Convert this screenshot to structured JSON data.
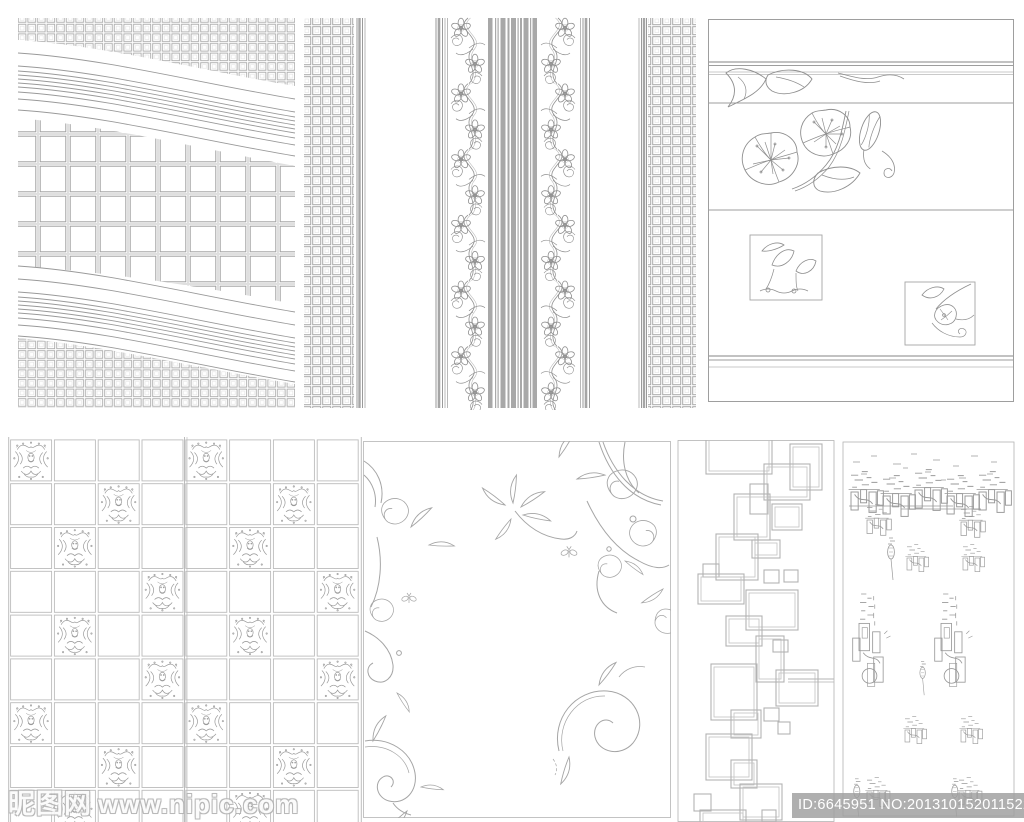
{
  "page": {
    "background": "#ffffff",
    "line_color": "#9a9a9a",
    "accent_gray": "#a8a8a8"
  },
  "watermark": {
    "site_name": "昵图网",
    "site_url": "www.nipic.com",
    "id_text": "ID:6645951 NO:20131015201152238000"
  },
  "panels": [
    {
      "id": "wave-grid",
      "label": "grid pattern crossed by wavy line bands"
    },
    {
      "id": "floral-stripe",
      "label": "vertical stripe wallpaper border with floral vines and mesh edges"
    },
    {
      "id": "flower-border",
      "label": "horizontal banded panel with hand-drawn blossoms and two framed flower sketches"
    },
    {
      "id": "damask-checker",
      "label": "checkerboard tile grid with ornate damask motifs on diagonals"
    },
    {
      "id": "swirl-flourish",
      "label": "corner floral swirl flourishes with leaves and butterflies"
    },
    {
      "id": "rect-cascade",
      "label": "cascading overlapped double-line rectangles strip"
    },
    {
      "id": "sketch-figures",
      "label": "scattered abstract plant / chandelier sketch clusters"
    }
  ],
  "damask": {
    "cols": 8,
    "rows": 9,
    "motif_rows": [
      [
        0,
        4
      ],
      [
        2,
        6
      ],
      [
        1,
        5
      ],
      [
        3,
        7
      ],
      [
        1,
        5
      ],
      [
        3,
        7
      ],
      [
        0,
        4
      ],
      [
        2,
        6
      ],
      [
        1,
        5
      ]
    ]
  }
}
